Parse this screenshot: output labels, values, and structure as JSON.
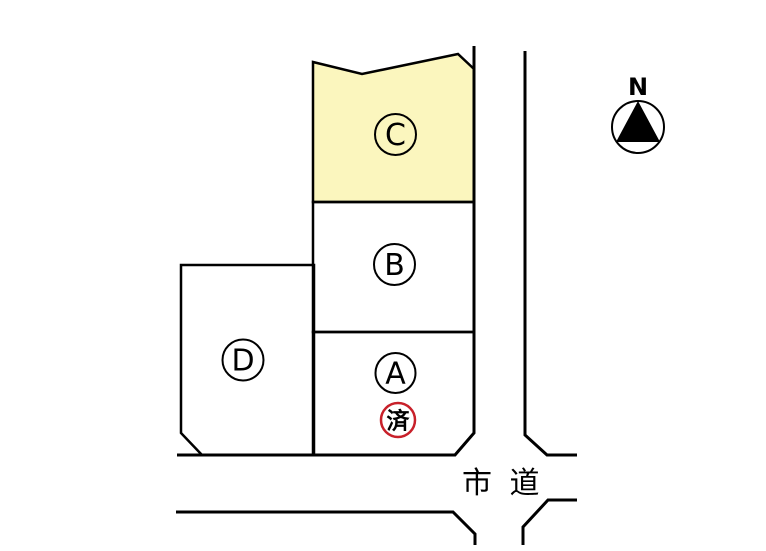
{
  "colors": {
    "background": "#FFFFFF",
    "outline": "#000000",
    "plot_c_fill": "#FBF6BE",
    "stamp_red": "#C8202A"
  },
  "plots": [
    {
      "id": "C",
      "label": "C"
    },
    {
      "id": "B",
      "label": "B"
    },
    {
      "id": "A",
      "label": "A"
    },
    {
      "id": "D",
      "label": "D"
    }
  ],
  "stamp": {
    "text": "済"
  },
  "road": {
    "label": "市 道"
  },
  "compass": {
    "label": "N"
  }
}
